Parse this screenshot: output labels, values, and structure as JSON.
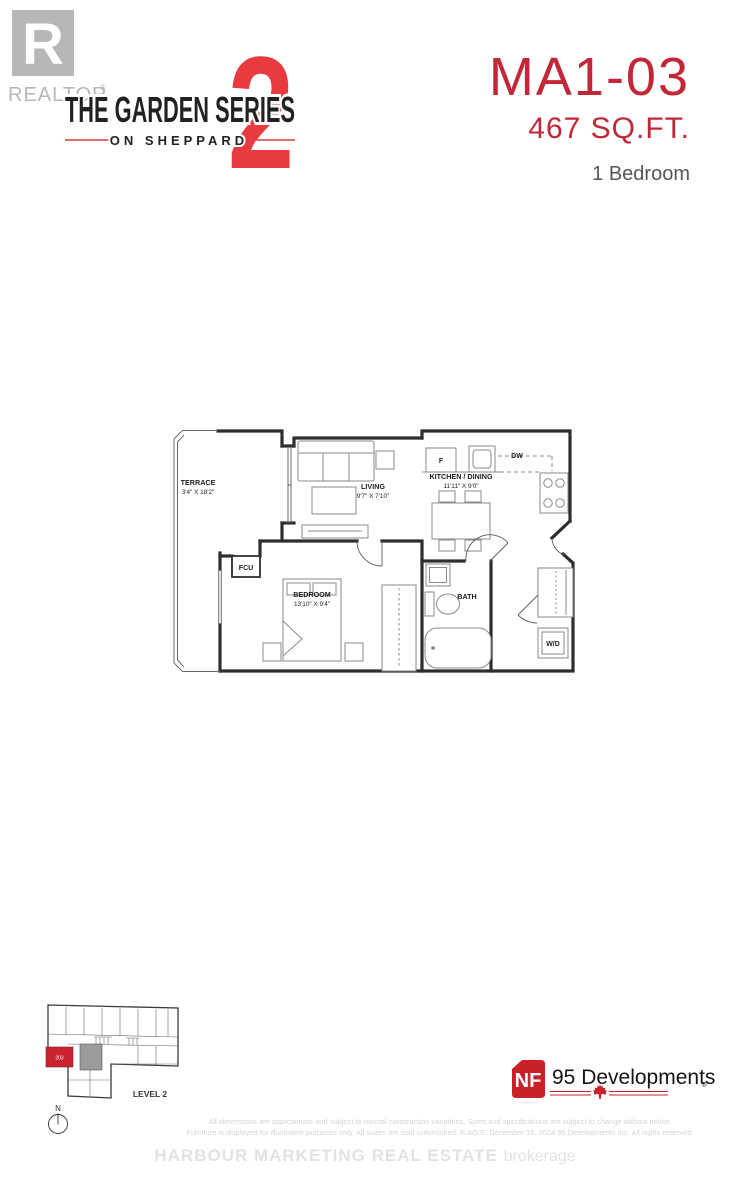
{
  "colors": {
    "brand_red": "#e73b40",
    "unit_red": "#c22737",
    "nf_red": "#c92127",
    "keyplan_red": "#c8232e",
    "muted_gray": "#55565a",
    "realtor_gray": "#b7b7b7",
    "faint_gray": "#d4d4d4"
  },
  "header": {
    "realtor": {
      "monogram": "R",
      "label": "REALTOR",
      "reg": "®"
    },
    "brand": {
      "line1": "THE GARDEN SERIES",
      "line2": "ON SHEPPARD",
      "numeral": "2"
    },
    "unit": {
      "model": "MA1-03",
      "area": "467 SQ.FT.",
      "type": "1 Bedroom"
    }
  },
  "floorplan": {
    "rooms": [
      {
        "name": "TERRACE",
        "dims": "3'4\" X 18'2\""
      },
      {
        "name": "LIVING",
        "dims": "9'7\" X 7'10\""
      },
      {
        "name": "KITCHEN / DINING",
        "dims": "11'11\" X 9'0\""
      },
      {
        "name": "BEDROOM",
        "dims": "13'10\" X 9'4\""
      },
      {
        "name": "BATH"
      }
    ],
    "appliances": {
      "fridge": "F",
      "dishwasher": "DW",
      "fcu": "FCU",
      "laundry": "W/D"
    }
  },
  "keyplan": {
    "level": "LEVEL 2",
    "north": "N",
    "unit_number": "203"
  },
  "developer": {
    "initials": "NF",
    "name": "95 Developments",
    "reg": "®"
  },
  "footer": {
    "disclaimer1": "All dimensions are approximate and subject to normal construction variations.  Sizes and specifications are subject to change without notice.",
    "disclaimer2": "Furniture is displayed for illustrative purposes only. All suites are sold unfurnished. E.&O.E. December 16, 2024 95 Developments Inc. All rights reserved.",
    "brokerage_name": "HARBOUR MARKETING REAL ESTATE",
    "brokerage_word": "brokerage"
  }
}
